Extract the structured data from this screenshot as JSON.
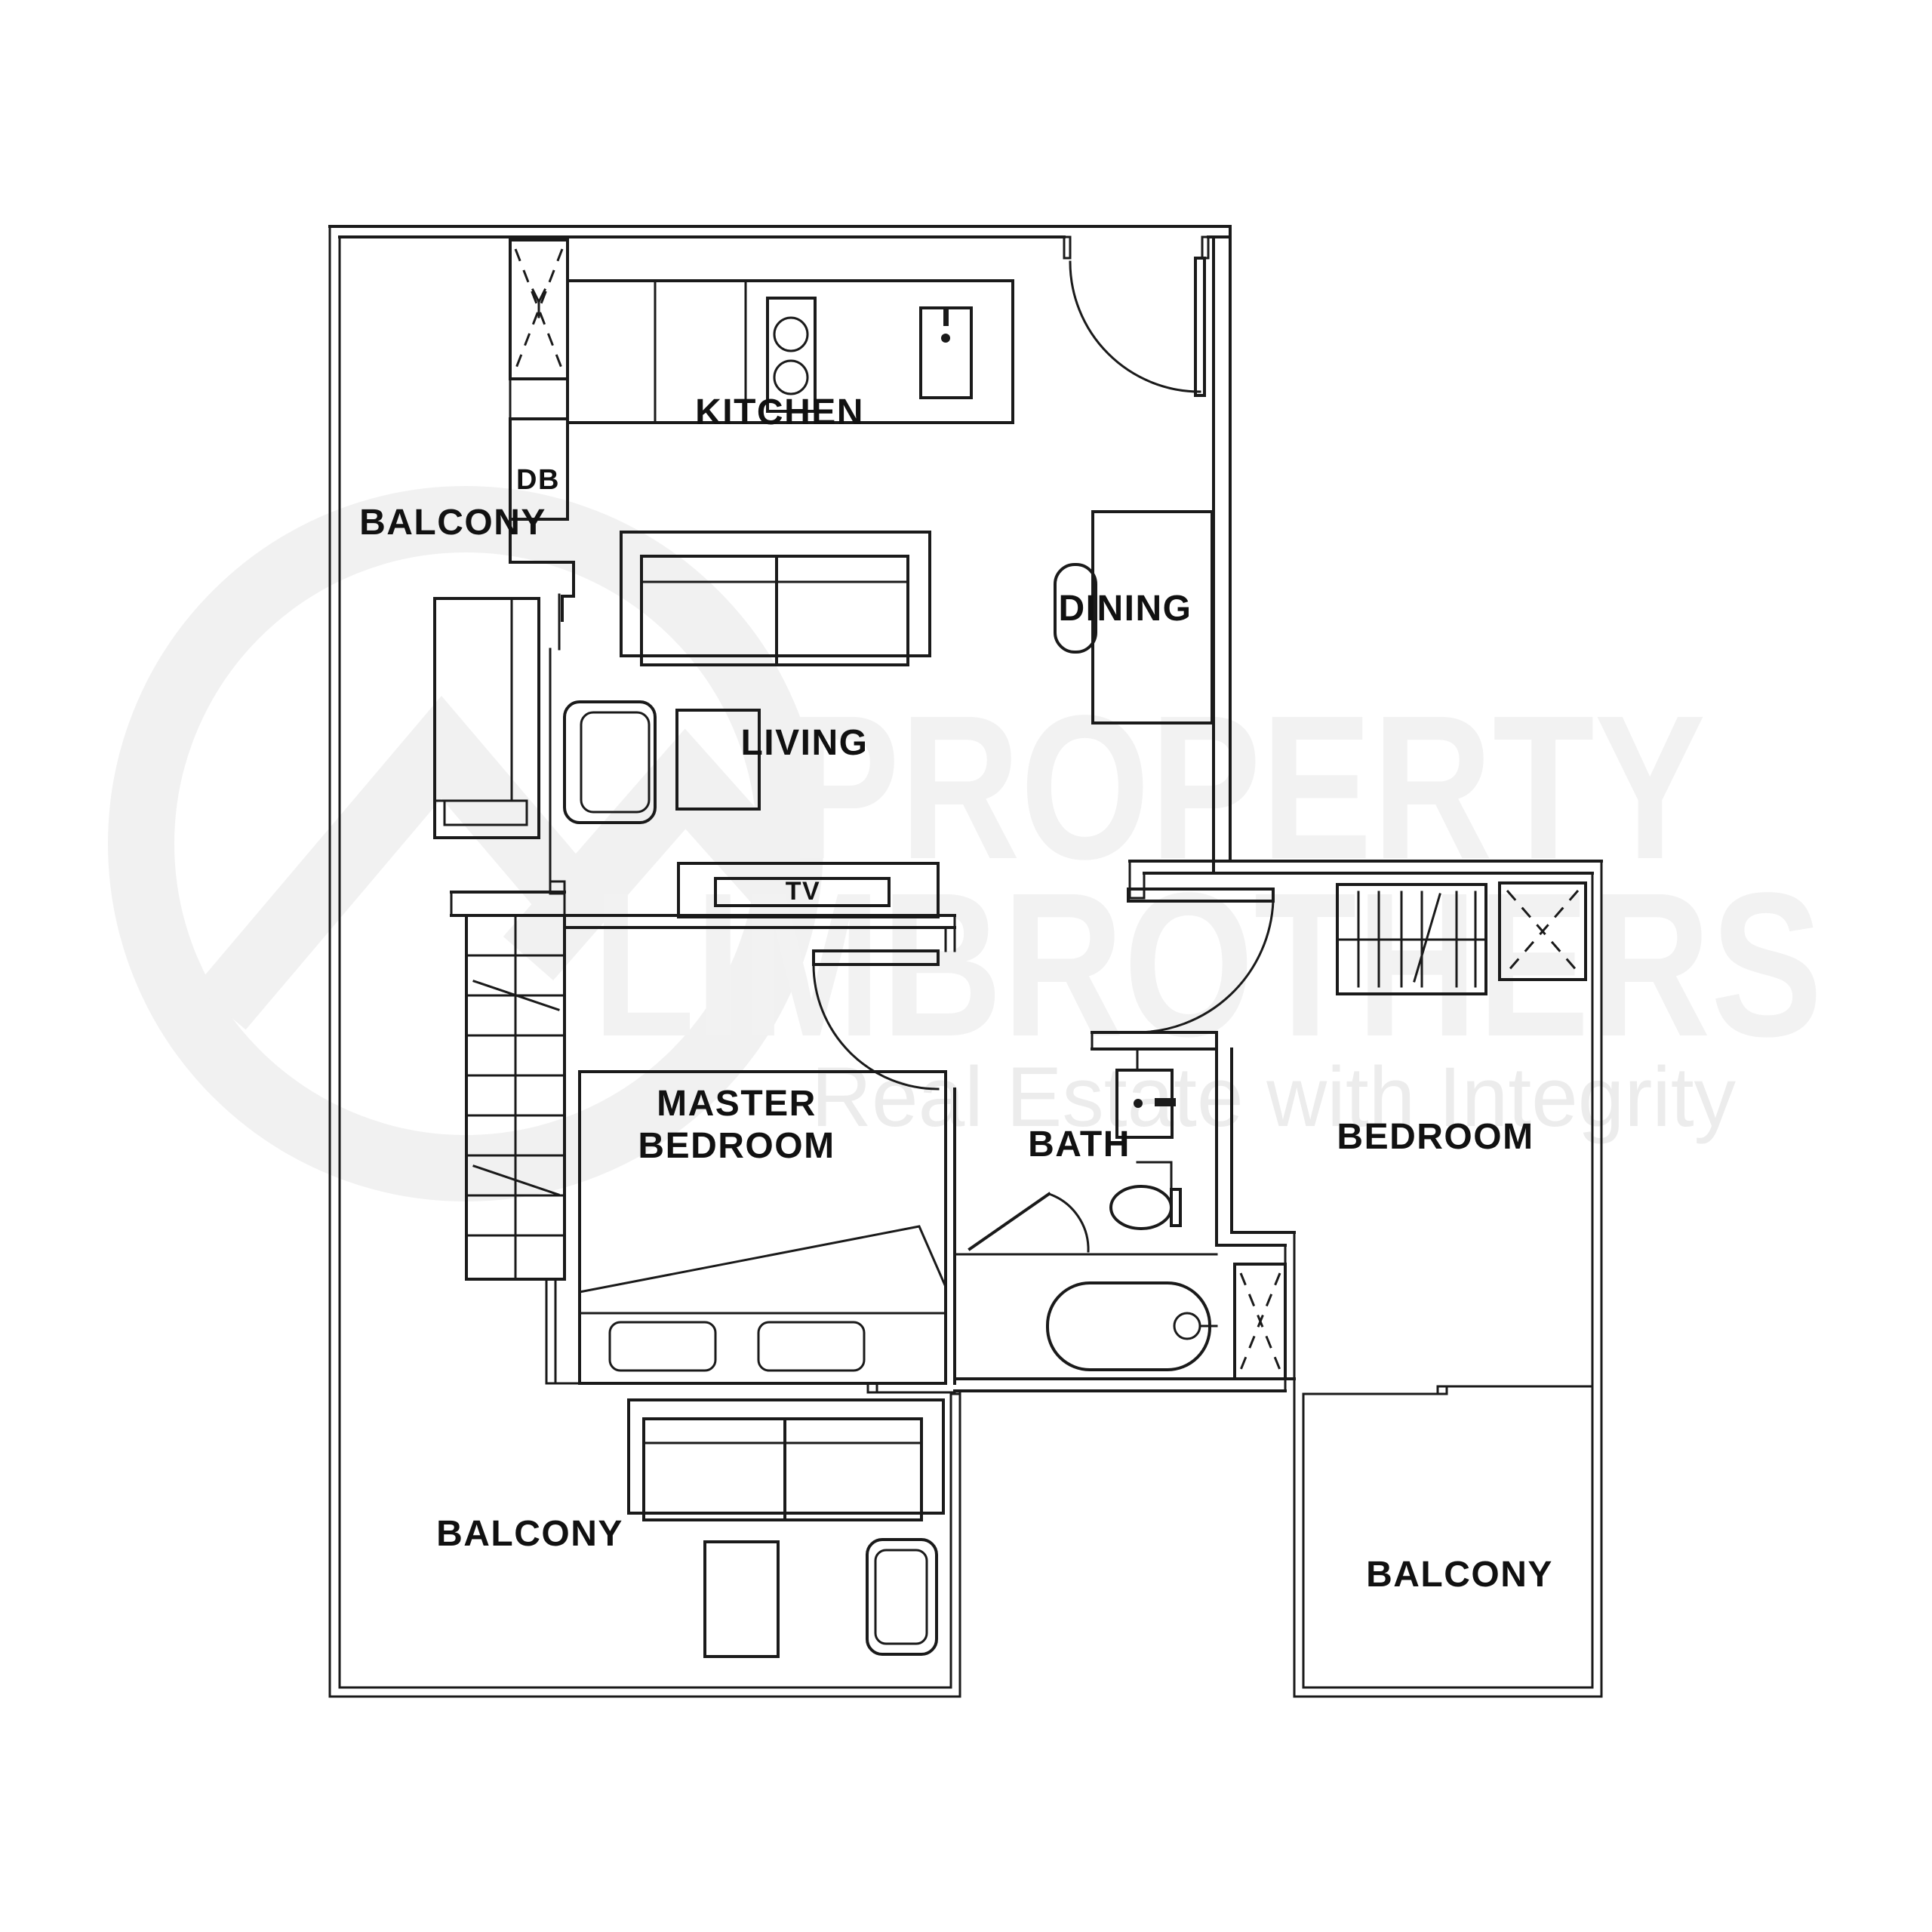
{
  "watermark": {
    "line1": "PROPERTY",
    "line2": "LIMBROTHERS",
    "tagline": "Real Estate with Integrity"
  },
  "labels": {
    "kitchen": "KITCHEN",
    "balcony_top_left": "BALCONY",
    "dining": "DINING",
    "living": "LIVING",
    "master_bedroom_line1": "MASTER",
    "master_bedroom_line2": "BEDROOM",
    "bath": "BATH",
    "bedroom": "BEDROOM",
    "balcony_bottom_left": "BALCONY",
    "balcony_bottom_right": "BALCONY",
    "tv": "TV",
    "db": "DB"
  },
  "fixtures": [
    "entrance-door",
    "kitchen-counter",
    "stove",
    "sink",
    "service-shaft",
    "distribution-board",
    "dining-table",
    "dining-chair",
    "sofa",
    "armchair",
    "coffee-table",
    "side-cabinet",
    "tv-console",
    "sliding-door",
    "wardrobe",
    "double-bed",
    "pillows",
    "basin",
    "toilet",
    "shower-screen",
    "bathtub",
    "ac-ledge",
    "balcony-sofa",
    "balcony-table",
    "balcony-armchair"
  ],
  "colors": {
    "background": "#ffffff",
    "line": "#1a1a1a",
    "label": "#111111",
    "watermark_logo": "#f1f1f1",
    "watermark_text": "#f2f2f2"
  }
}
